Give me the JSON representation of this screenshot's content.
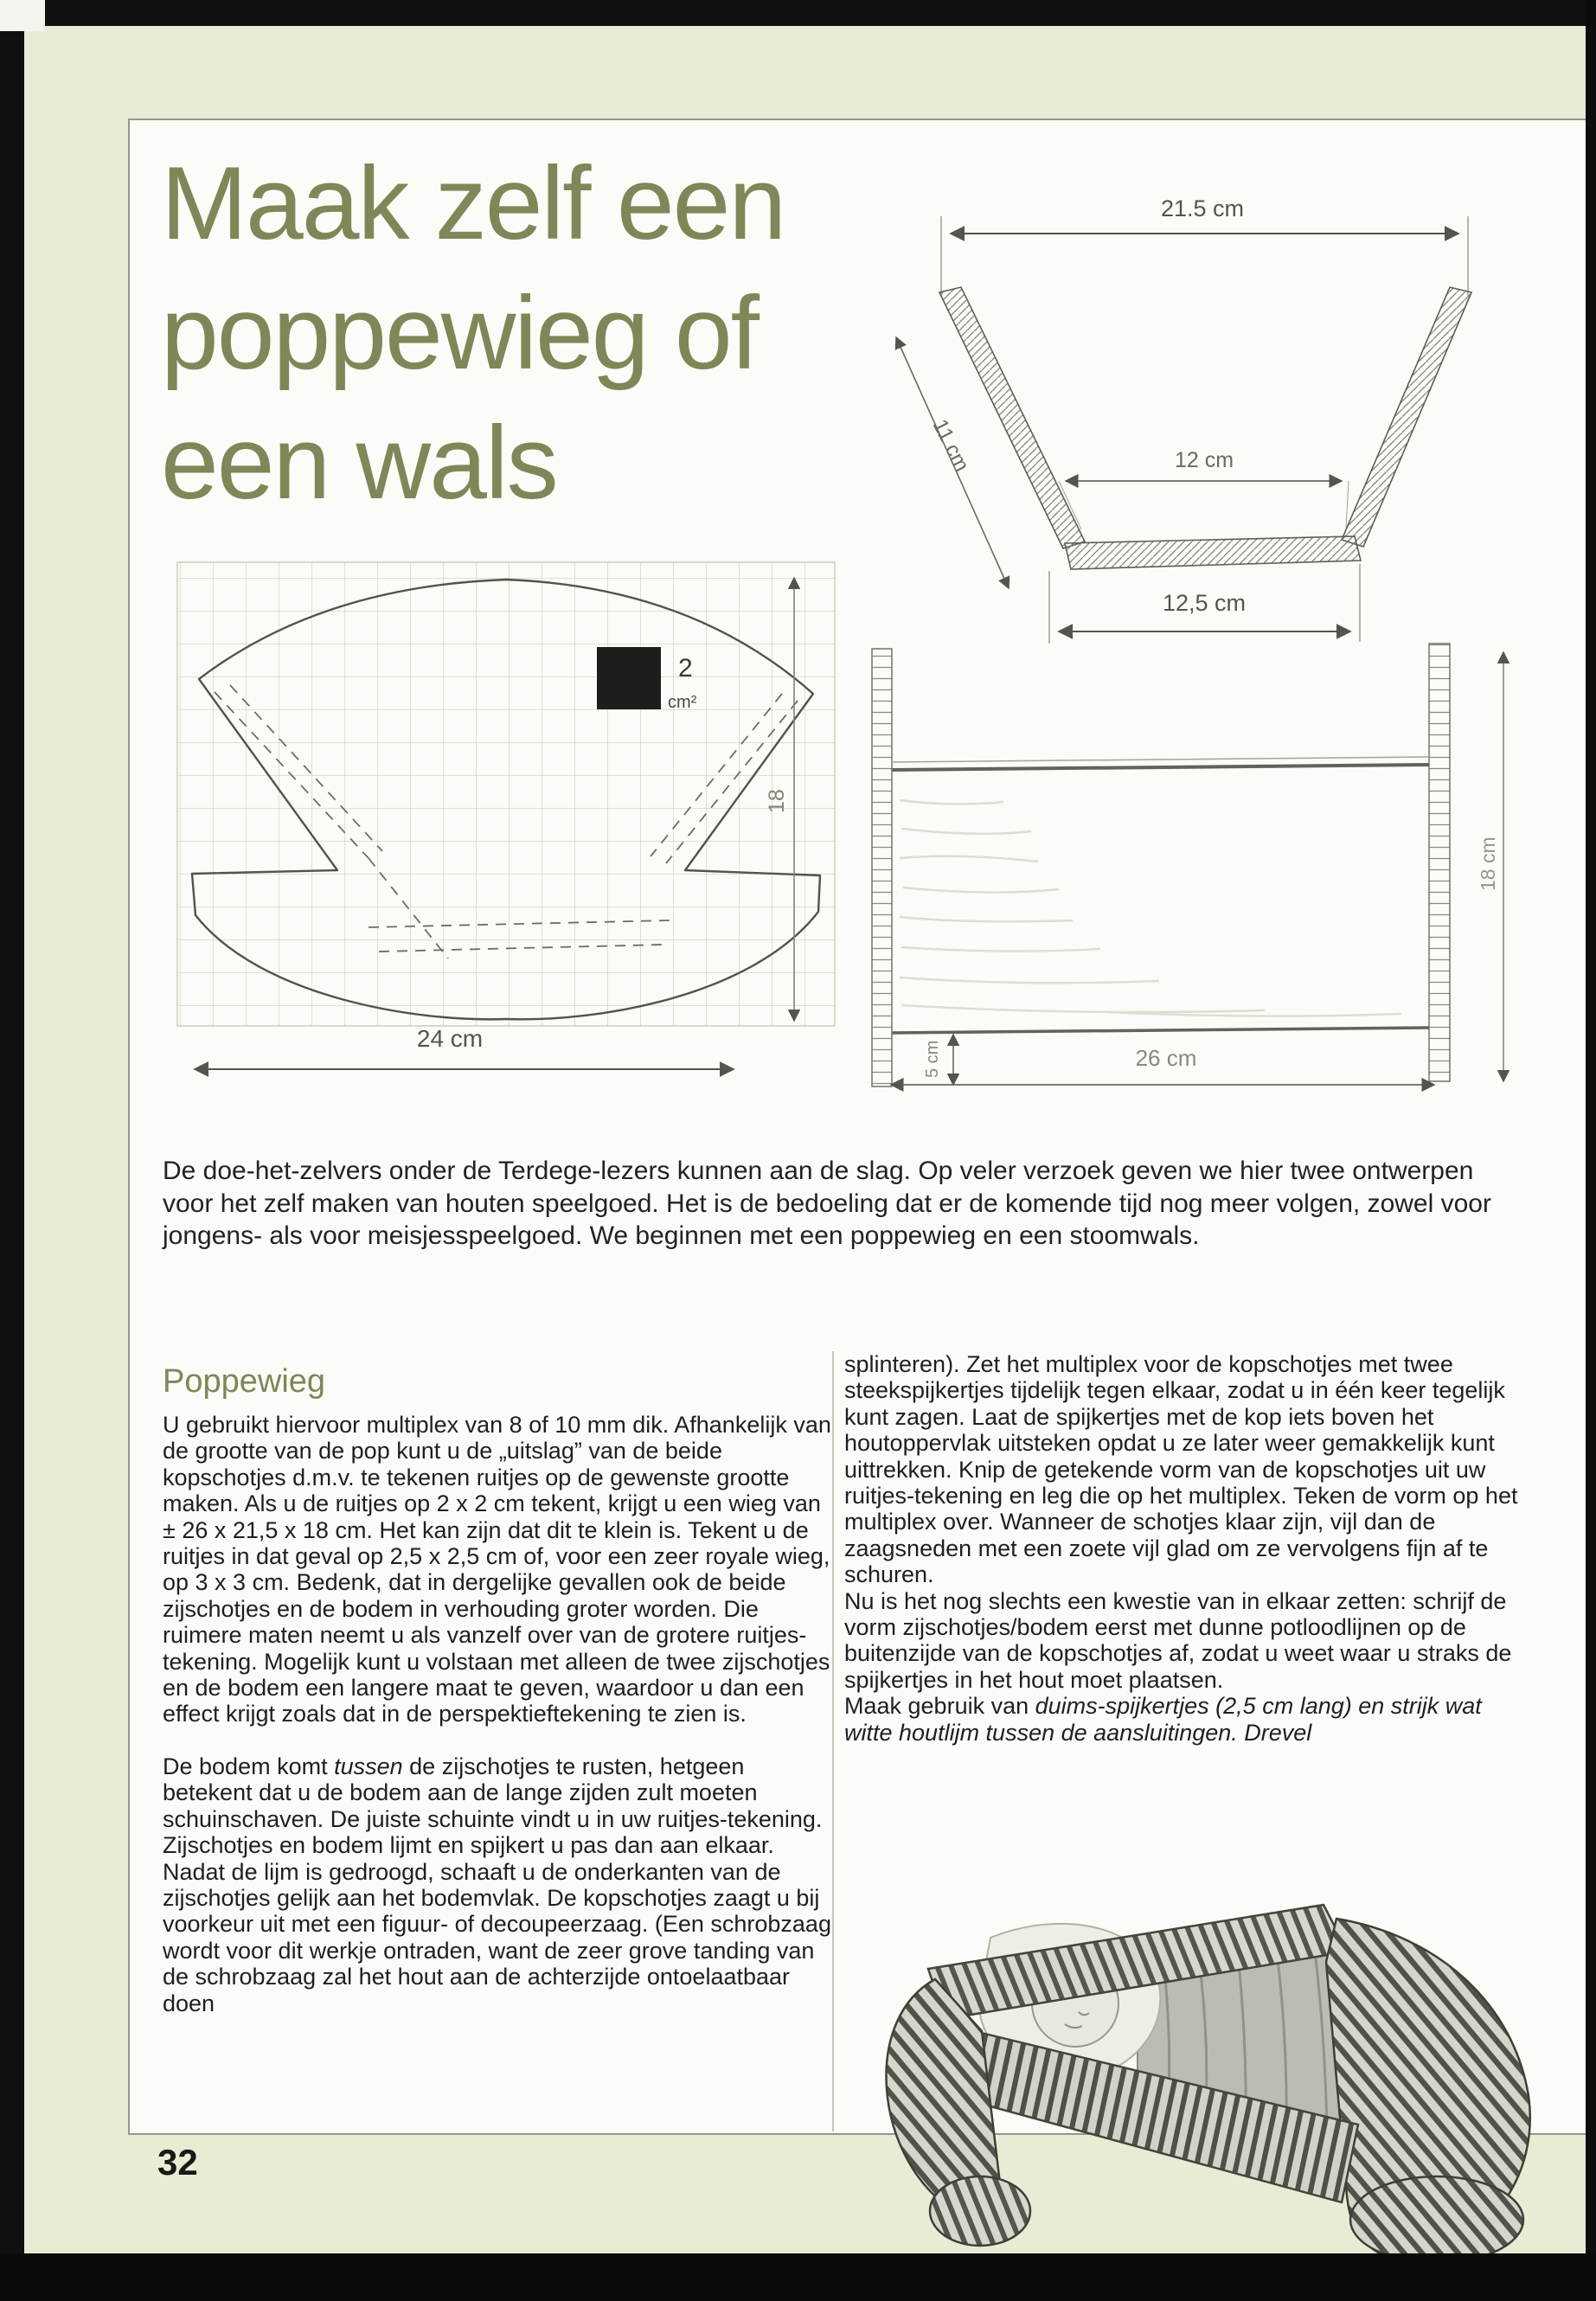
{
  "page": {
    "number": "32",
    "background_color": "#e9ecd4",
    "accent_color": "#7e8757",
    "paper_color": "#fbfbf7"
  },
  "title": {
    "line1": "Maak zelf een",
    "line2": "poppewieg of",
    "line3": "een wals"
  },
  "intro": "De doe-het-zelvers onder de Terdege-lezers kunnen aan de slag. Op veler verzoek geven we hier twee ontwerpen voor het zelf maken van houten speelgoed. Het is de bedoeling dat er de komende tijd nog meer volgen, zowel voor jongens- als voor meisjesspeelgoed. We beginnen met een poppewieg en een stoomwals.",
  "article": {
    "heading": "Poppewieg",
    "left": {
      "p1": "U gebruikt hiervoor multiplex van 8 of 10 mm dik. Afhankelijk van de grootte van de pop kunt u de „uitslag” van de beide kopschotjes d.m.v. te tekenen ruitjes op de gewenste grootte maken. Als u de ruitjes op 2 x 2 cm tekent, krijgt u een wieg van ± 26 x 21,5 x 18 cm. Het kan zijn dat dit te klein is. Tekent u de ruitjes in dat geval op 2,5 x 2,5 cm of, voor een zeer royale wieg, op 3 x 3 cm. Bedenk, dat in dergelijke gevallen ook de beide zijschotjes en de bodem in verhouding groter worden. Die ruimere maten neemt u als vanzelf over van de grotere ruitjes-tekening. Mogelijk kunt u volstaan met alleen de twee zijschotjes en de bodem een langere maat te geven, waardoor u dan een effect krijgt zoals dat in de perspektieftekening te zien is.",
      "p2": [
        {
          "t": "De bodem komt "
        },
        {
          "t": "tussen",
          "i": true
        },
        {
          "t": " de zijschotjes te rusten, hetgeen betekent dat u de bodem aan de lange zijden zult moeten schuinschaven. De juiste schuinte vindt u in uw ruitjes-tekening."
        }
      ],
      "p3": "Zijschotjes en bodem lijmt en spijkert u pas dan aan elkaar. Nadat de lijm is gedroogd, schaaft u de onderkanten van de zijschotjes gelijk aan het bodemvlak. De kopschotjes zaagt u bij voorkeur uit met een figuur- of decoupeerzaag. (Een schrobzaag wordt voor dit werkje ontraden, want de zeer grove tanding van de schrobzaag zal het hout aan de achterzijde ontoelaatbaar doen"
    },
    "right": {
      "p4": "splinteren). Zet het multiplex voor de kopschotjes met twee steekspijkertjes tijdelijk tegen elkaar, zodat u in één keer tegelijk kunt zagen. Laat de spijkertjes met de kop iets boven het houtoppervlak uitsteken opdat u ze later weer gemakkelijk kunt uittrekken. Knip de getekende vorm van de kopschotjes uit uw ruitjes-tekening en leg die op het multiplex. Teken de vorm op het multiplex over. Wanneer de schotjes klaar zijn, vijl dan de zaagsneden met een zoete vijl glad om ze vervolgens fijn af te schuren.",
      "p5": "Nu is het nog slechts een kwestie van in elkaar zetten: schrijf de vorm zijschotjes/bodem eerst met dunne potloodlijnen op de buitenzijde van de kopschotjes af, zodat u weet waar u straks de spijkertjes in het hout moet plaatsen.",
      "p6": [
        {
          "t": "Maak gebruik van "
        },
        {
          "t": "duims-spijkertjes (2,5 cm lang) en strijk wat witte houtlijm tussen de aansluitingen. Drevel",
          "i": true
        }
      ]
    }
  },
  "diagrams": {
    "cross_section": {
      "top_width": "21.5 cm",
      "inner_width": "12 cm",
      "bottom_width": "12,5 cm",
      "side_length": "11 cm"
    },
    "head_board": {
      "square_value": "2",
      "square_unit": "cm²",
      "width": "24 cm",
      "height": "18"
    },
    "side_view": {
      "bottom_offset": "5 cm",
      "length": "26 cm",
      "height": "18 cm"
    }
  }
}
